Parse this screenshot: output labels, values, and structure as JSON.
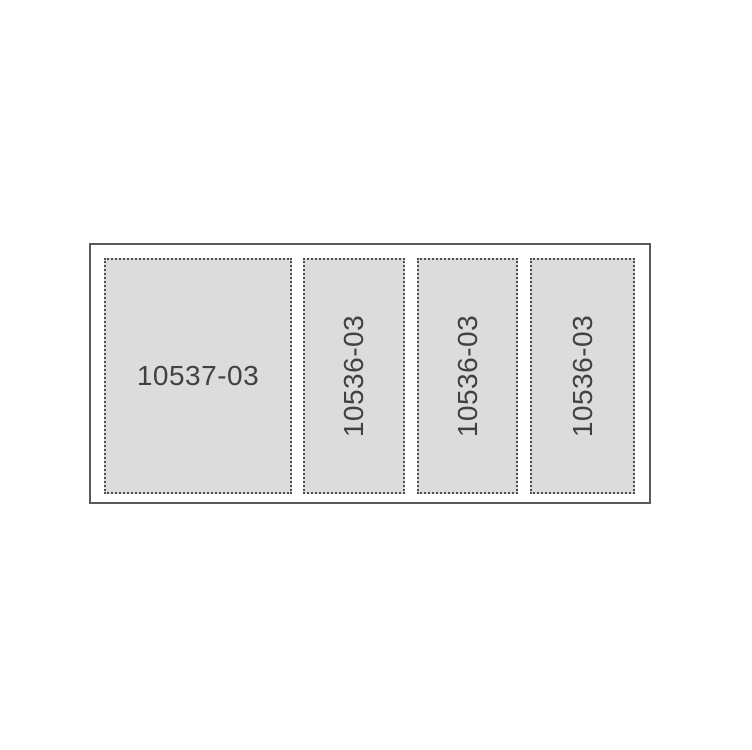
{
  "diagram": {
    "description": "Panel layout diagram with part numbers",
    "frame": {
      "shape": "rectangle",
      "border_style": "solid"
    },
    "panels": [
      {
        "label": "10537-03",
        "orientation": "horizontal",
        "border_style": "dotted"
      },
      {
        "label": "10536-03",
        "orientation": "vertical",
        "border_style": "dotted"
      },
      {
        "label": "10536-03",
        "orientation": "vertical",
        "border_style": "dotted"
      },
      {
        "label": "10536-03",
        "orientation": "vertical",
        "border_style": "dotted"
      }
    ],
    "colors": {
      "background": "#ffffff",
      "panel_fill": "#dcdcdd",
      "dot_border": "#4d4d4f",
      "frame_border": "#58595b",
      "label_text": "#414042"
    }
  }
}
